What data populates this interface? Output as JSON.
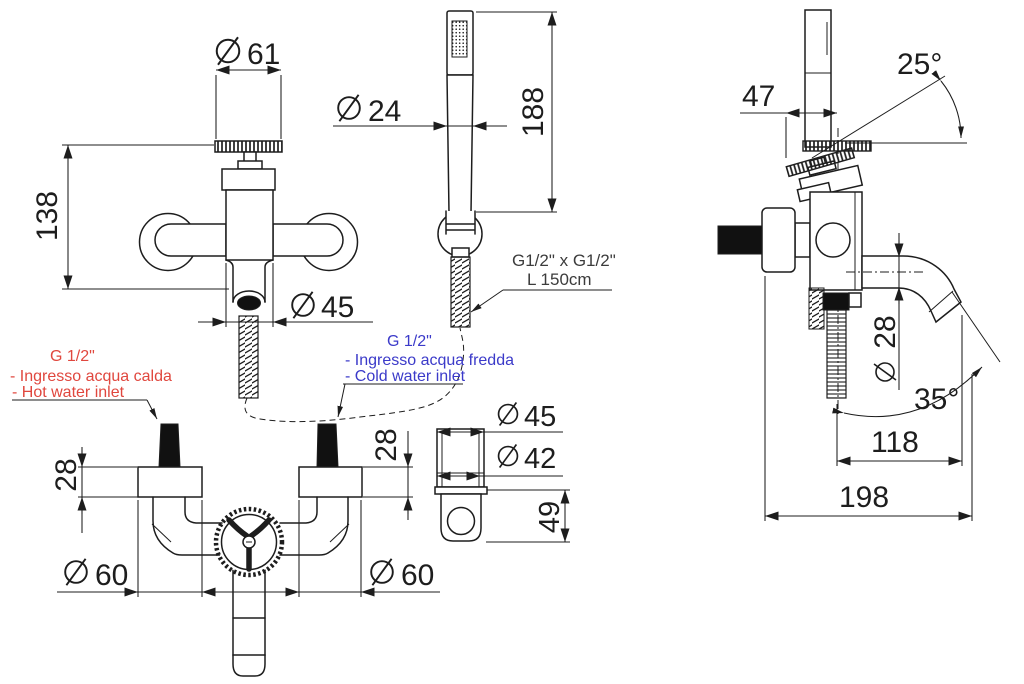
{
  "title": "Bath mixer technical drawing",
  "annotations": {
    "hot_water": {
      "thread": "G 1/2\"",
      "line1": "- Ingresso acqua calda",
      "line2": "- Hot water inlet"
    },
    "cold_water": {
      "thread": "G 1/2\"",
      "line1": "- Ingresso acqua fredda",
      "line2": "- Cold water inlet"
    },
    "hose": {
      "line1": "G1/2\" x G1/2\"",
      "line2": "L 150cm"
    }
  },
  "dimensions": {
    "front_view": {
      "handle_diameter": "61",
      "height": "138",
      "body_diameter": "45"
    },
    "hand_shower": {
      "diameter": "24",
      "length": "188"
    },
    "bottom_view": {
      "left_inlet_height": "28",
      "right_inlet_height": "28",
      "left_escutcheon_diameter": "60",
      "right_escutcheon_diameter": "60"
    },
    "holder_detail": {
      "outer_diameter": "45",
      "inner_diameter": "42",
      "depth": "49"
    },
    "side_view": {
      "handle_offset": "47",
      "handle_angle": "25°",
      "spout_diameter": "28",
      "spray_angle": "35°",
      "spout_projection": "118",
      "total_projection": "198"
    }
  },
  "icons": {
    "diameter_symbol": "circle-with-slash"
  },
  "colors": {
    "line": "#1d1d1d",
    "hot_water_label": "#e0473e",
    "cold_water_label": "#3b3ac9",
    "solid_fill": "#111111",
    "background": "#ffffff"
  }
}
